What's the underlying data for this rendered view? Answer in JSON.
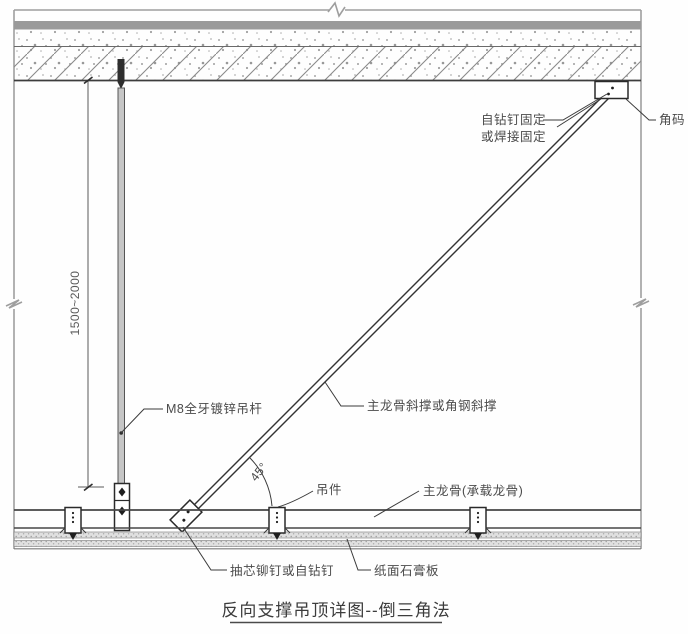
{
  "title": {
    "text": "反向支撑吊顶详图--倒三角法"
  },
  "dimension": {
    "text": "1500~2000"
  },
  "angle": {
    "text": "45°"
  },
  "labels": {
    "fixing_line1": "自钻钉固定",
    "fixing_line2": "或焊接固定",
    "corner_bracket": "角码",
    "hanger_rod": "M8全牙镀锌吊杆",
    "diagonal_brace": "主龙骨斜撑或角钢斜撑",
    "hanger_clip": "吊件",
    "main_runner": "主龙骨(承载龙骨)",
    "rivet": "抽芯铆钉或自钻钉",
    "gypsum_board": "纸面石膏板"
  },
  "colors": {
    "background": "#fefefe",
    "slab_band": "#9a9a9a",
    "line_dark": "#3d3d3d",
    "line_frame": "#9e9e9e",
    "hatch_line": "#8a8a8a",
    "text": "#4a4a4a"
  }
}
